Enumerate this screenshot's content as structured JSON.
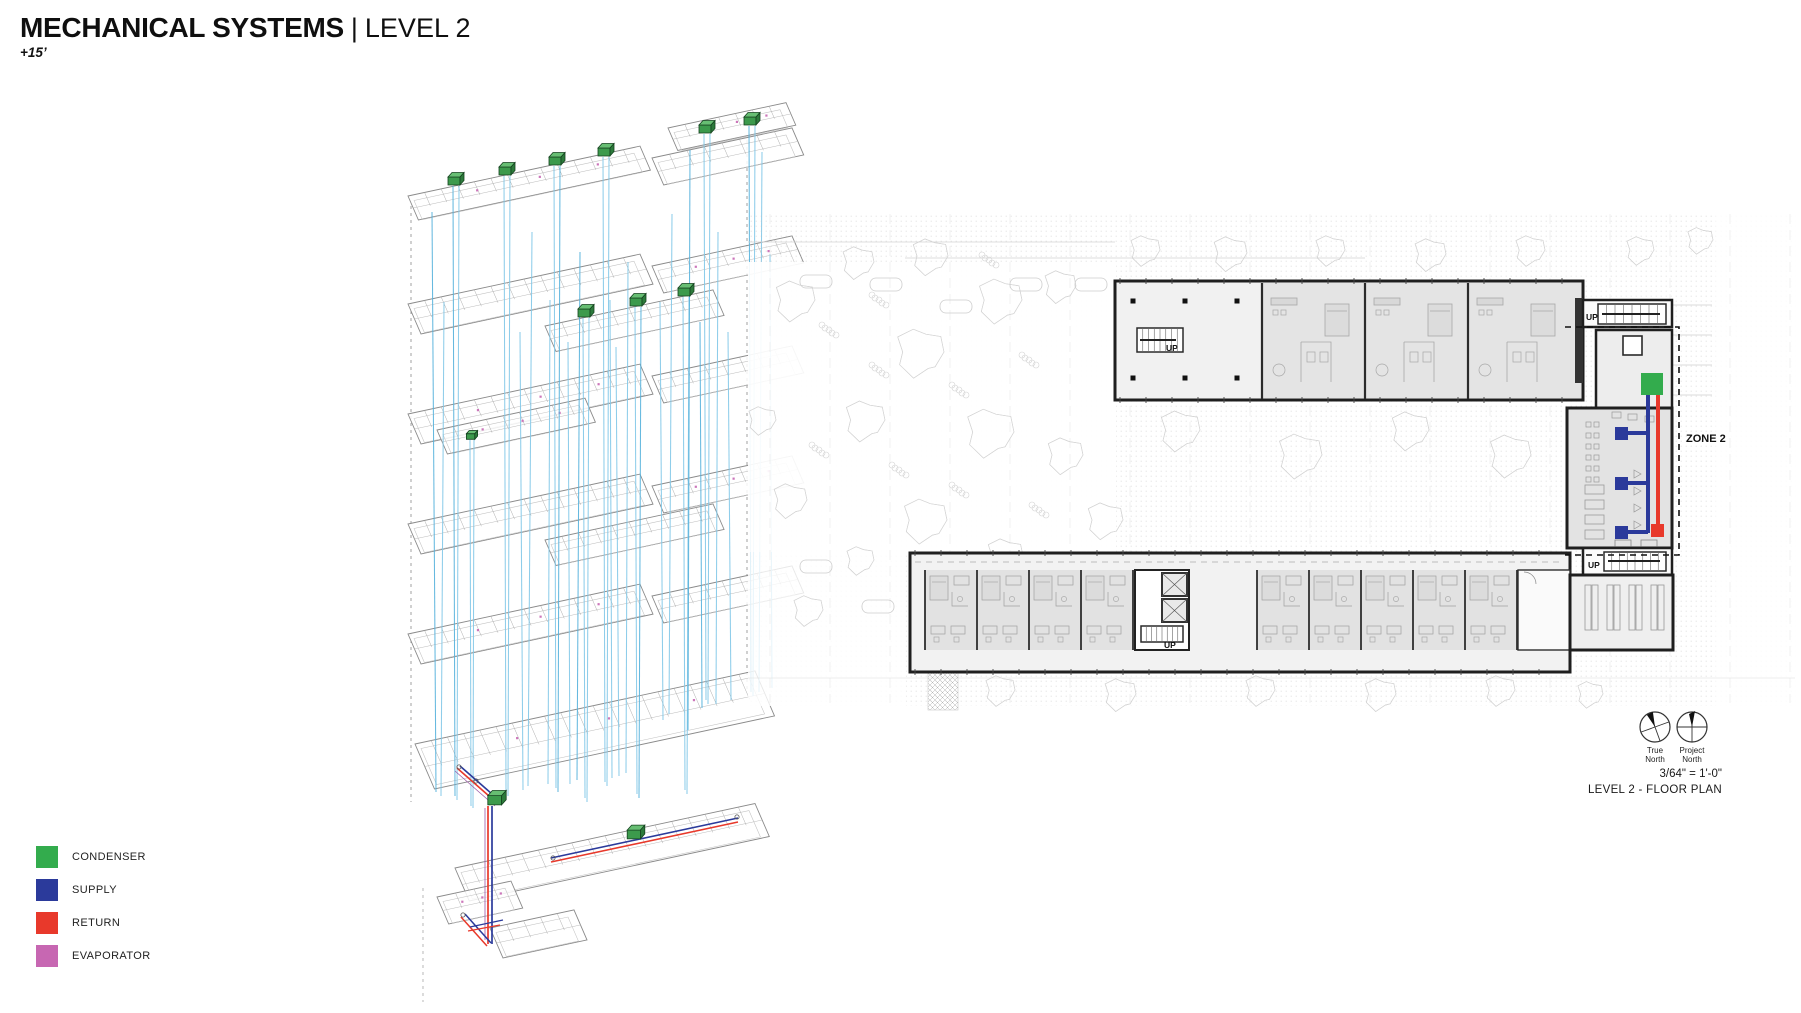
{
  "header": {
    "title": "MECHANICAL SYSTEMS",
    "separator": "|",
    "level": "LEVEL 2",
    "elevation": "+15’"
  },
  "legend": [
    {
      "id": "condenser",
      "label": "CONDENSER",
      "color": "#33AC4D"
    },
    {
      "id": "supply",
      "label": "SUPPLY",
      "color": "#2B3A9B"
    },
    {
      "id": "return",
      "label": "RETURN",
      "color": "#E8392B"
    },
    {
      "id": "evaporator",
      "label": "EVAPORATOR",
      "color": "#C767B2"
    }
  ],
  "plan": {
    "zone_label": "ZONE 2",
    "stair_label": "UP",
    "true_north_label_line1": "True",
    "true_north_label_line2": "North",
    "project_north_label_line1": "Project",
    "project_north_label_line2": "North",
    "scale_note": "3/64\" = 1'-0\"",
    "drawing_title": "LEVEL 2 - FLOOR PLAN"
  },
  "colors": {
    "riser": "#82C8E8",
    "riser_dark": "#55B1DC",
    "evap_pipe": "#9C59A8"
  }
}
